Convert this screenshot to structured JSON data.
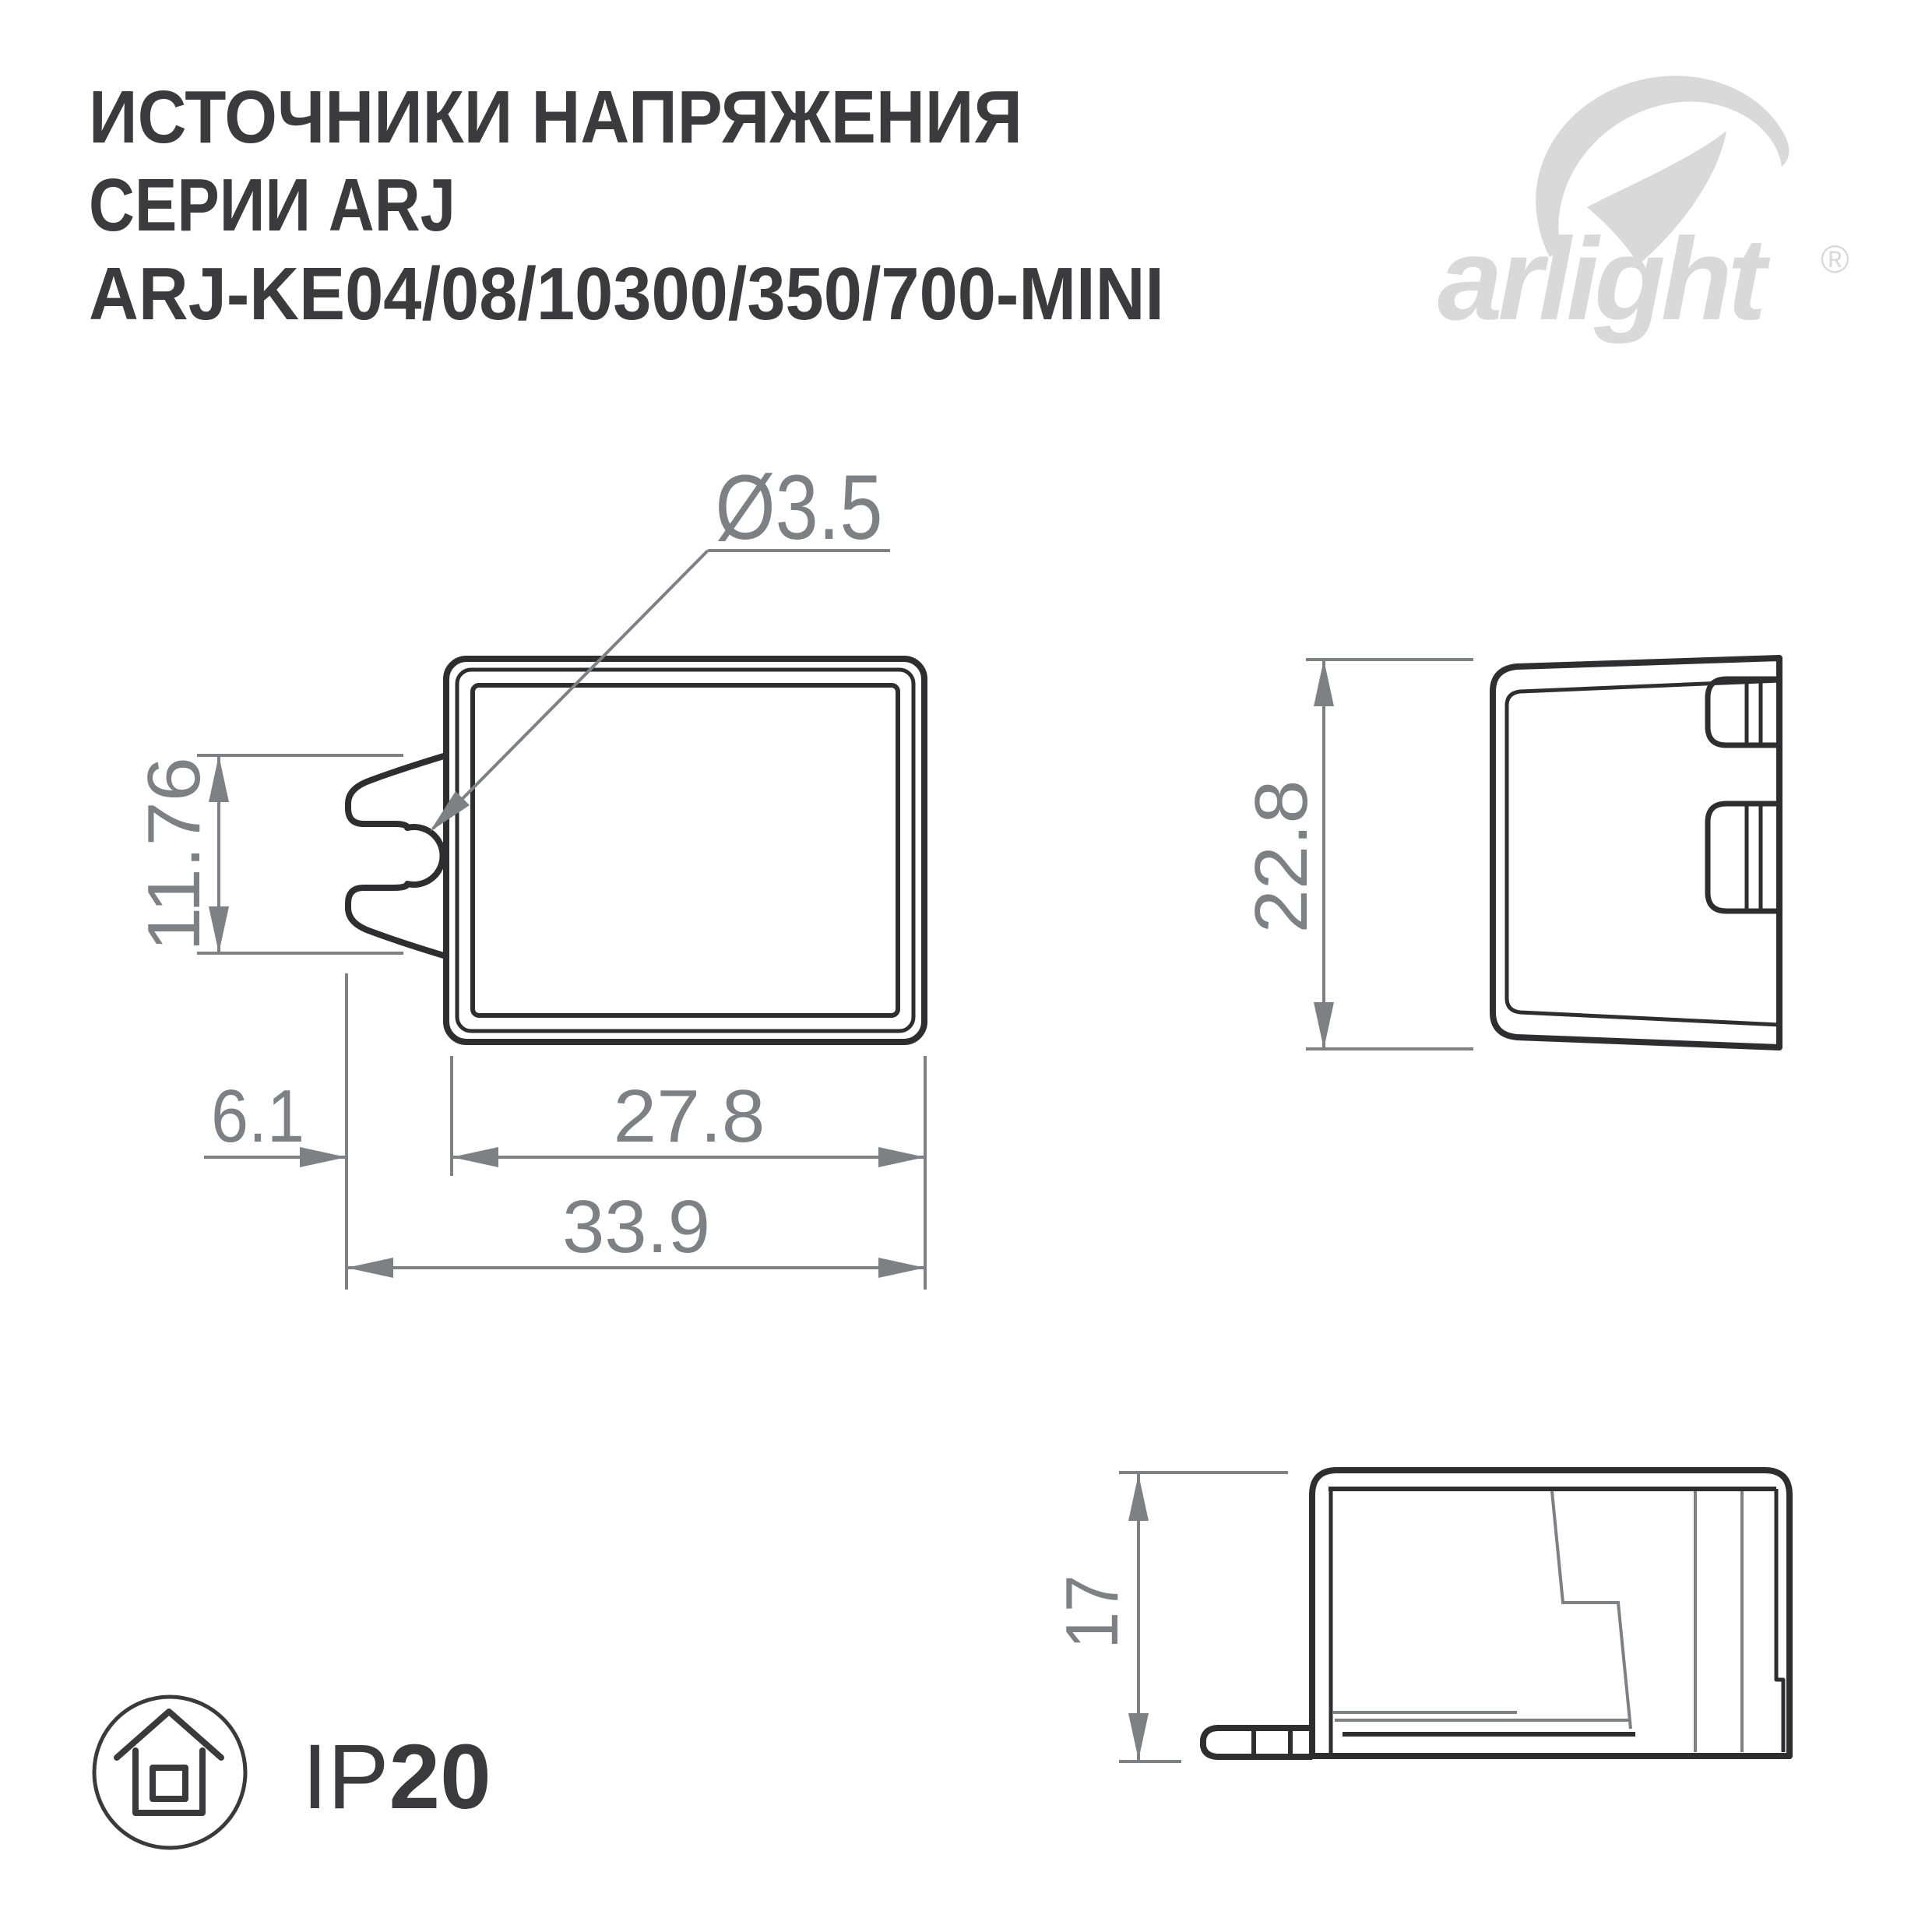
{
  "header": {
    "title_line1": "ИСТОЧНИКИ НАПРЯЖЕНИЯ",
    "title_line2": "СЕРИИ ARJ",
    "title_line3": "ARJ-KE04/08/10300/350/700-MINI"
  },
  "logo": {
    "text": "arlight",
    "registered": "®",
    "icon": "arlight-swoosh-icon"
  },
  "views": {
    "front": {
      "hole_diameter": "Ø3.5",
      "notch_height": "11.76",
      "body_width": "27.8",
      "tab_offset": "6.1",
      "total_width": "33.9"
    },
    "side": {
      "height": "22.8"
    },
    "profile": {
      "height": "17"
    }
  },
  "badge": {
    "prefix": "IP",
    "rating": "20",
    "icon": "indoor-house-icon"
  },
  "colors": {
    "background": "#ffffff",
    "outline_dark": "#2e2e30",
    "dimension_gray": "#7f8083",
    "title_text": "#3b3b3d",
    "logo_gray": "#d9d9da"
  }
}
